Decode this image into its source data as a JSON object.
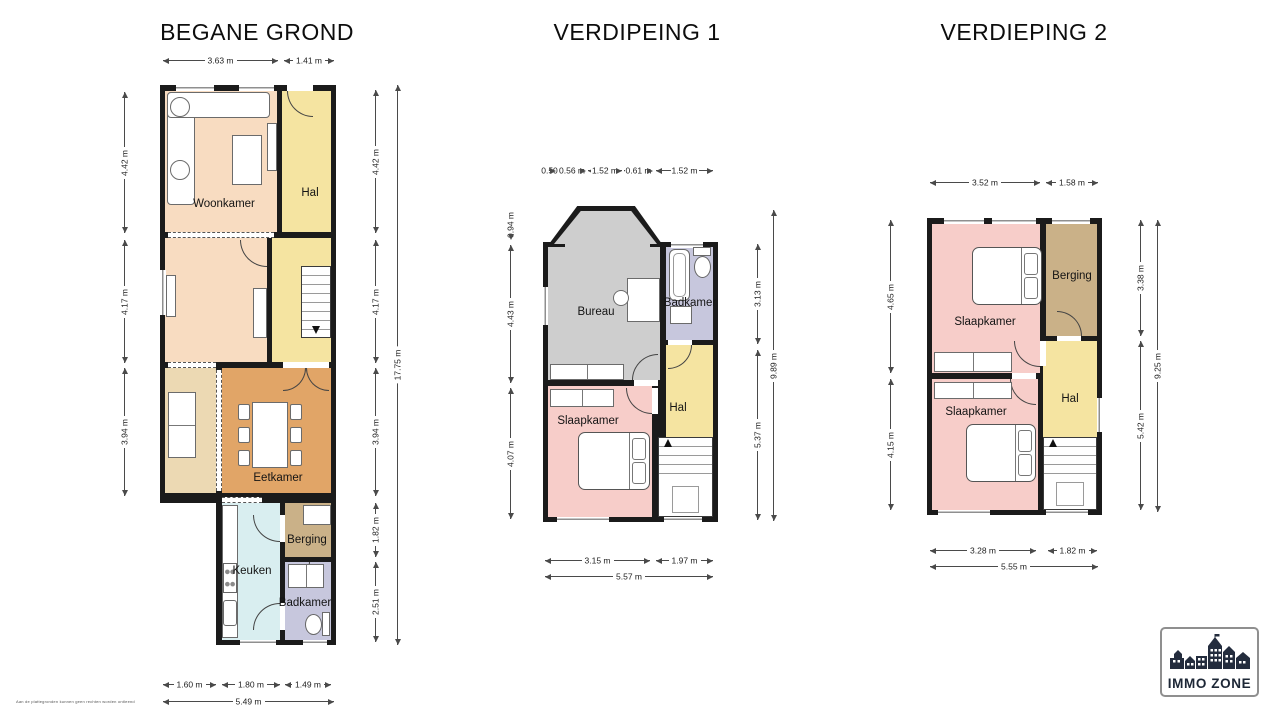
{
  "disclaimer": "Aan de plattegronden kunnen geen rechten worden ontleend",
  "logo": {
    "text": "IMMO ZONE",
    "brand_color": "#1d2736"
  },
  "palette": {
    "wall": "#1b1b1b",
    "woonkamer": "#f8dcc1",
    "hal": "#f5e4a1",
    "eetkamer": "#e1a567",
    "side_room": "#ecd9b3",
    "keuken": "#d9eef0",
    "berging": "#cab188",
    "badkamer": "#c7c7dd",
    "bureau": "#cecece",
    "slaapkamer": "#f7cdc9"
  },
  "plans": [
    {
      "title": "BEGANE GROND",
      "rooms": {
        "woonkamer": "Woonkamer",
        "hal": "Hal",
        "eetkamer": "Eetkamer",
        "keuken": "Keuken",
        "berging": "Berging",
        "badkamer": "Badkamer"
      },
      "dims": {
        "top": [
          "3.63 m",
          "1.41 m"
        ],
        "left": [
          "4.42 m",
          "4.17 m",
          "3.94 m"
        ],
        "right": [
          "4.42 m",
          "4.17 m",
          "3.94 m",
          "1.82 m",
          "2.51 m"
        ],
        "right_total": "17.75 m",
        "bottom": [
          "1.60 m",
          "1.80 m",
          "1.49 m"
        ],
        "bottom_total": "5.49 m"
      }
    },
    {
      "title": "VERDIPEING 1",
      "rooms": {
        "bureau": "Bureau",
        "badkamer": "Badkamer",
        "slaapkamer": "Slaapkamer",
        "hal": "Hal"
      },
      "dims": {
        "top": [
          "0.50",
          "0.56 m",
          "1.52 m",
          "0.61 m",
          "1.52 m"
        ],
        "left": [
          "0.94 m",
          "4.43 m",
          "4.07 m"
        ],
        "right": [
          "3.13 m",
          "5.37 m"
        ],
        "right_total": "9.89 m",
        "bottom": [
          "3.15 m",
          "1.97 m"
        ],
        "bottom_total": "5.57 m"
      }
    },
    {
      "title": "VERDIEPING 2",
      "rooms": {
        "slaapkamer1": "Slaapkamer",
        "berging": "Berging",
        "hal": "Hal",
        "slaapkamer2": "Slaapkamer"
      },
      "dims": {
        "top": [
          "3.52 m",
          "1.58 m"
        ],
        "left": [
          "4.65 m",
          "4.15 m"
        ],
        "right": [
          "3.38 m",
          "5.42 m"
        ],
        "right_total": "9.25 m",
        "bottom": [
          "3.28 m",
          "1.82 m"
        ],
        "bottom_total": "5.55 m"
      }
    }
  ]
}
